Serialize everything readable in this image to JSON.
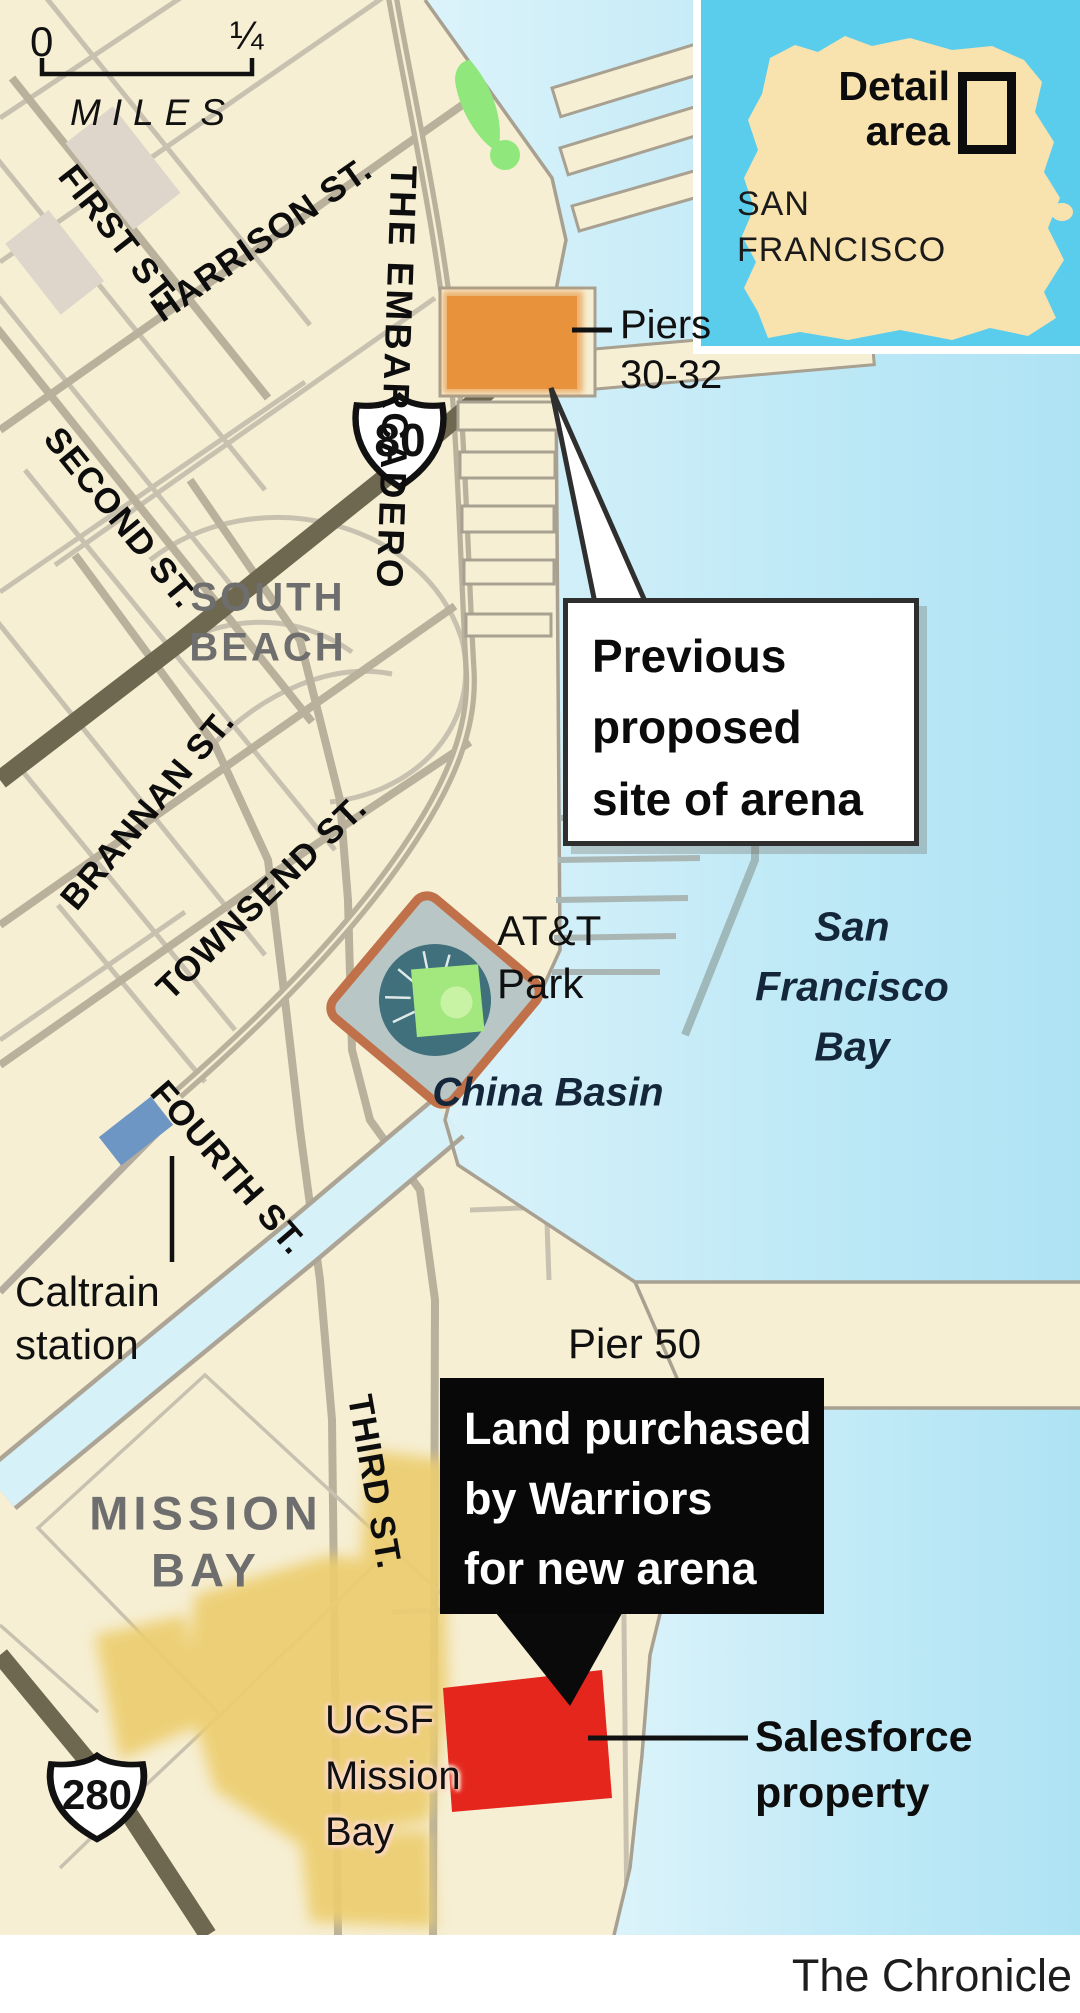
{
  "scale": {
    "zero": "0",
    "quarter": "¼",
    "unit": "MILES"
  },
  "streets": {
    "first": "FIRST ST.",
    "second": "SECOND ST.",
    "harrison": "HARRISON ST.",
    "embarcadero": "THE EMBARCADERO",
    "brannan": "BRANNAN ST.",
    "townsend": "TOWNSEND ST.",
    "fourth": "FOURTH ST.",
    "third": "THIRD ST."
  },
  "highways": {
    "i80": "80",
    "i280": "280"
  },
  "districts": {
    "south_beach": [
      "SOUTH",
      "BEACH"
    ],
    "mission_bay": [
      "MISSION",
      "BAY"
    ]
  },
  "water_labels": {
    "china_basin": "China Basin",
    "sf_bay": [
      "San",
      "Francisco",
      "Bay"
    ]
  },
  "pois": {
    "piers_3032": [
      "Piers",
      "30-32"
    ],
    "att_park": [
      "AT&T",
      "Park"
    ],
    "caltrain": [
      "Caltrain",
      "station"
    ],
    "pier50": "Pier 50",
    "ucsf": [
      "UCSF",
      "Mission",
      "Bay"
    ]
  },
  "annotations": {
    "previous_site": [
      "Previous",
      "proposed",
      "site of arena"
    ],
    "warriors_land": [
      "Land purchased",
      "by  Warriors",
      "for new arena"
    ],
    "salesforce": [
      "Salesforce",
      "property"
    ]
  },
  "inset": {
    "detail": [
      "Detail",
      "area"
    ],
    "city": [
      "SAN",
      "FRANCISCO"
    ]
  },
  "credit": "The Chronicle",
  "colors": {
    "land": "#f6efd3",
    "water": "#bfe9f6",
    "inset_water": "#5bcdec",
    "road": "#b9b19c",
    "freeway": "#6f6850",
    "previous_site_orange": "#e8923c",
    "warriors_site_red": "#e5261d",
    "ucsf_gold": "#eccd70",
    "stadium_teal": "#3f707c",
    "field_green": "#a3e87e",
    "caltrain_blue": "#6d96c4"
  }
}
